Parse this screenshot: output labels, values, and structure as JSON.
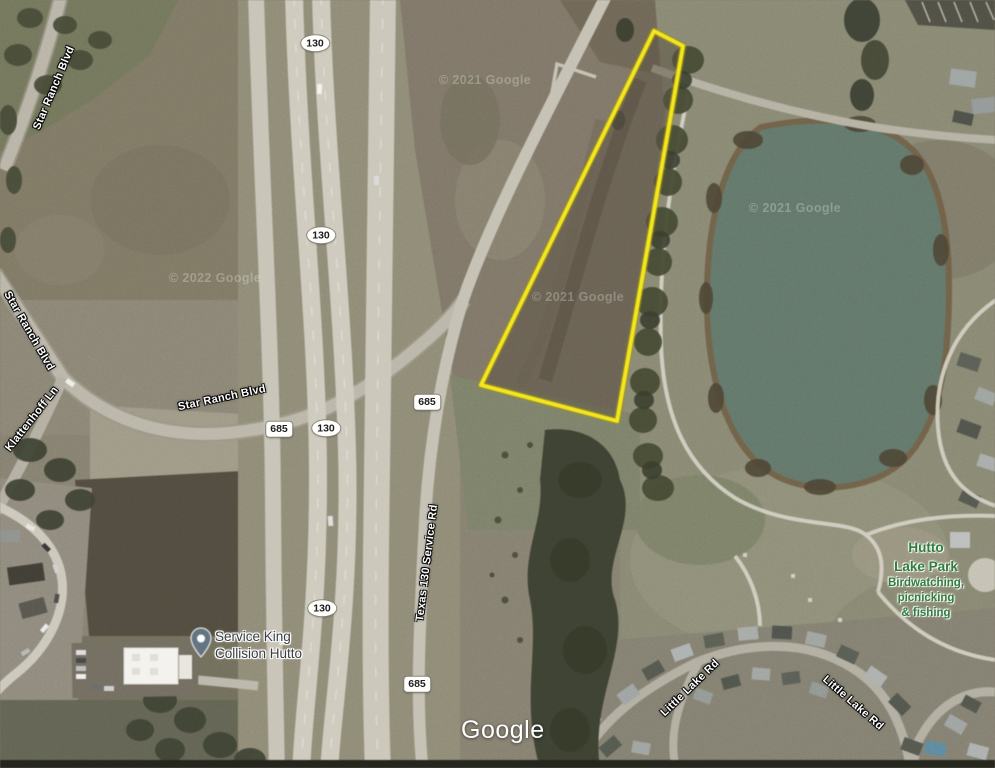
{
  "map": {
    "type": "satellite",
    "attribution": {
      "logo_text": "Google"
    },
    "copyright_watermarks": [
      {
        "text": "© 2021 Google"
      },
      {
        "text": "© 2022 Google"
      },
      {
        "text": "© 2021 Google"
      },
      {
        "text": "© 2021 Google"
      }
    ],
    "parcel_outline": {
      "color": "#f6e70e",
      "halo_color": "#9a8b07",
      "points": "654,31 683,46 617,421 481,385"
    },
    "route_shields": {
      "toll_130": "130",
      "fm_685": "685"
    },
    "road_labels": {
      "star_ranch_blvd_nw": "Star Ranch Blvd",
      "star_ranch_blvd_w": "Star Ranch Blvd",
      "klattenhoff_ln": "Klattenhoff Ln",
      "star_ranch_blvd_center": "Star Ranch Blvd",
      "texas_130_service_rd": "Texas 130 Service Rd",
      "little_lake_rd_west": "Little Lake Rd",
      "little_lake_rd_east": "Little Lake Rd"
    },
    "pois": {
      "service_king": {
        "name_line1": "Service King",
        "name_line2": "Collision Hutto"
      },
      "hutto_lake_park": {
        "name_line1": "Hutto",
        "name_line2": "Lake Park",
        "desc_line1": "Birdwatching,",
        "desc_line2": "picnicking",
        "desc_line3": "& fishing",
        "label_color": "#2e7d3e"
      }
    },
    "water_color": "#5e7365"
  }
}
